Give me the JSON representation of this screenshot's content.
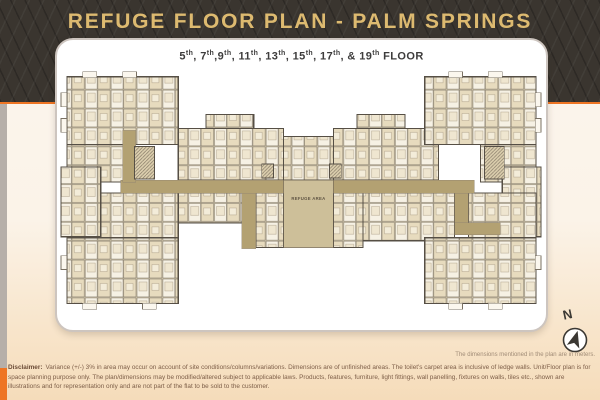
{
  "header": {
    "title": "REFUGE FLOOR PLAN - PALM SPRINGS",
    "ordinal": "th",
    "floors": [
      {
        "n": "5",
        "sep": ", "
      },
      {
        "n": "7",
        "sep": ","
      },
      {
        "n": "9",
        "sep": ", "
      },
      {
        "n": "11",
        "sep": ", "
      },
      {
        "n": "13",
        "sep": ", "
      },
      {
        "n": "15",
        "sep": ", "
      },
      {
        "n": "17",
        "sep": ", & "
      },
      {
        "n": "19",
        "sep": " "
      }
    ],
    "floors_tail": "FLOOR"
  },
  "plan": {
    "refuge_label": "REFUGE AREA"
  },
  "compass": {
    "label": "N"
  },
  "notes": {
    "dimensions": "The dimensions mentioned in the plan are in meters."
  },
  "disclaimer": {
    "label": "Disclaimer:",
    "text": "Variance (+/-) 3% in area may occur on account of site conditions/columns/variations. Dimensions are of unfinished areas. The toilet's carpet area is inclusive of ledge walls. Unit/Floor plan is for space planning purpose only. The plan/dimensions may be modified/altered subject to applicable laws. Products, features, furniture, light fittings, wall panelling, fixtures on walls, tiles etc., shown are illustrations and for representation only and are not part of the flat to be sold to the customer."
  },
  "colors": {
    "accent_orange": "#ee7524",
    "title_gold": "#ddba70",
    "corridor_tan": "#b3a172",
    "header_dark": "#3a352f"
  }
}
